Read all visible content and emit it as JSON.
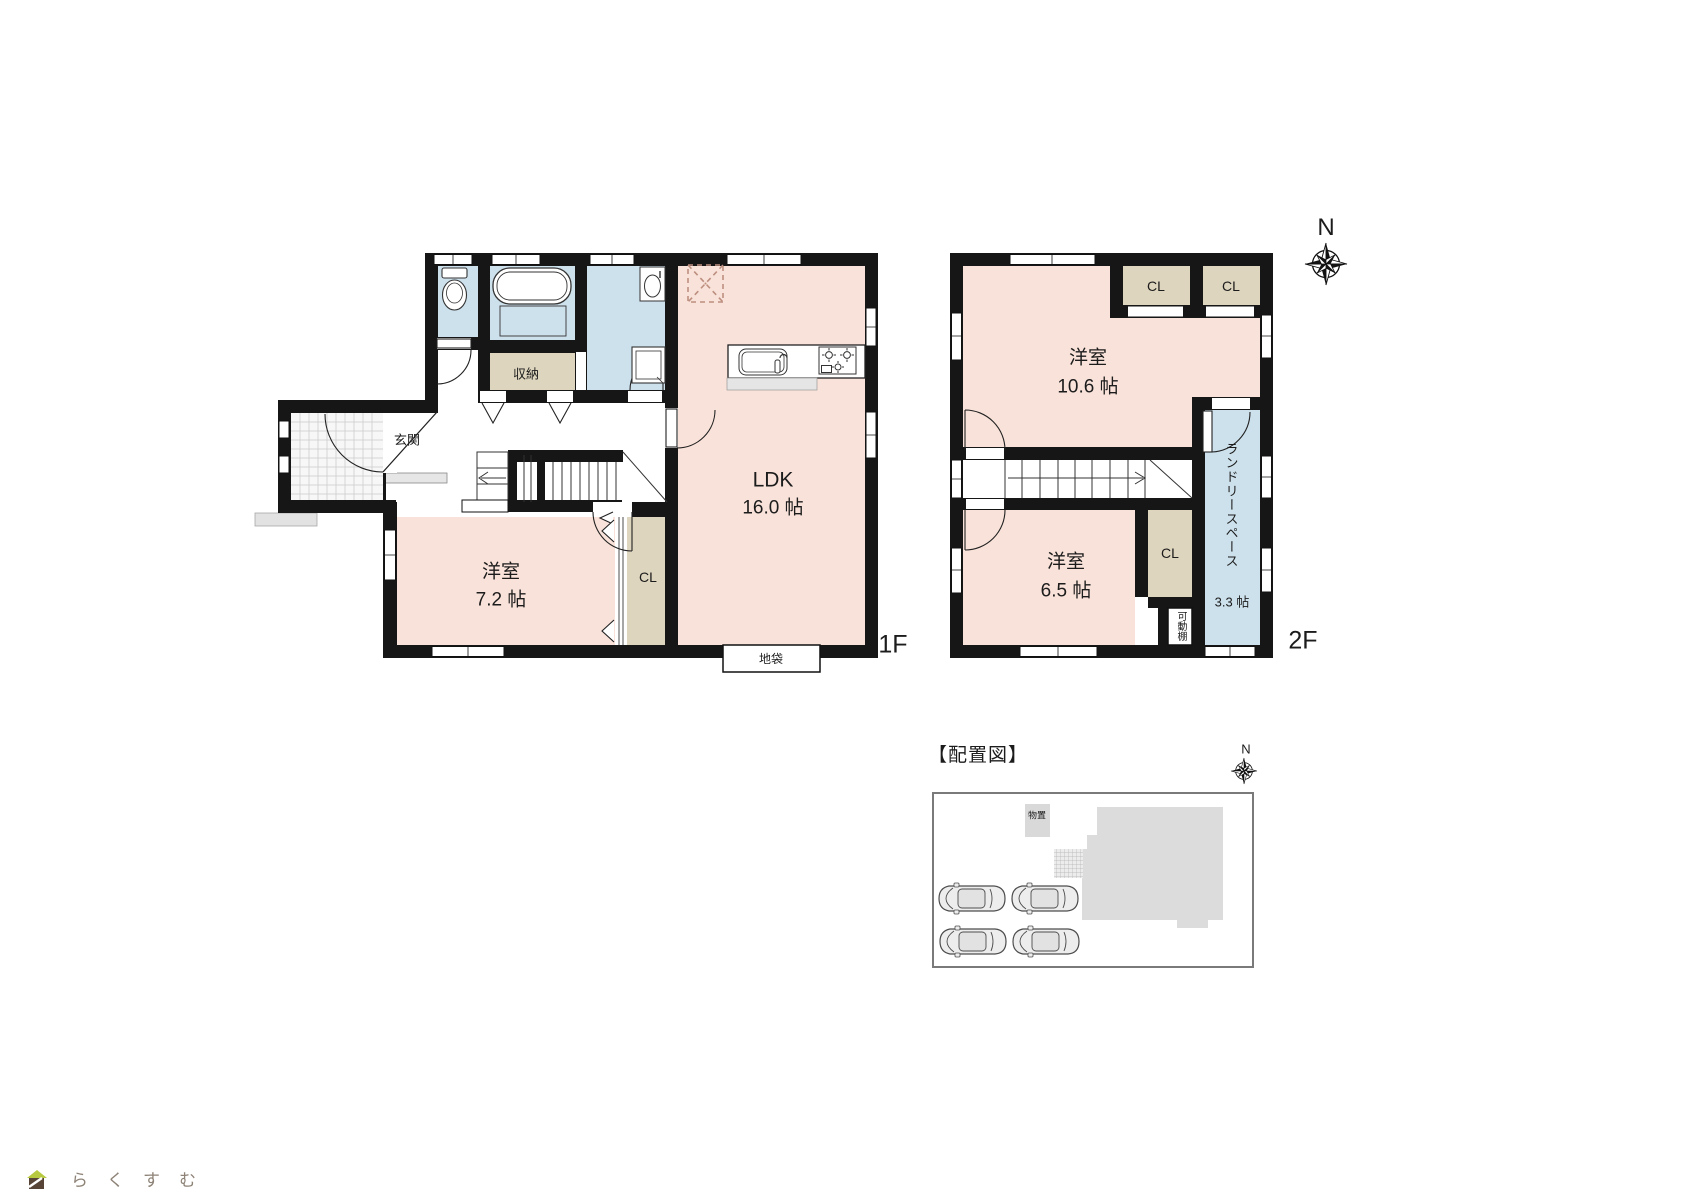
{
  "colors": {
    "room_pink": "#f9e2d9",
    "wet_blue": "#cde1ec",
    "closet_beige": "#ded5be",
    "wall_black": "#161616",
    "site_gray": "#dcdcdc",
    "dashed_accent": "#bd8f80",
    "logo_roof_green": "#b7c93f",
    "logo_body_brown": "#584437",
    "logo_text_brown": "#8d8276"
  },
  "floor1": {
    "label": "1F",
    "entrance": "玄関",
    "storage": "収納",
    "room": {
      "name": "洋室",
      "size": "7.2 帖"
    },
    "closet": "CL",
    "ldk": {
      "name": "LDK",
      "size": "16.0 帖"
    },
    "floor_cabinet": "地袋"
  },
  "floor2": {
    "label": "2F",
    "room_large": {
      "name": "洋室",
      "size": "10.6 帖"
    },
    "closet_a": "CL",
    "closet_b": "CL",
    "room_small": {
      "name": "洋室",
      "size": "6.5 帖"
    },
    "closet_c": "CL",
    "movable_shelf": "可動棚",
    "laundry": {
      "name": "ランドリースペース",
      "size": "3.3 帖"
    }
  },
  "compass": {
    "north": "N"
  },
  "site": {
    "title": "【配置図】",
    "shed": "物置"
  },
  "logo": {
    "text": "らくすむ"
  }
}
